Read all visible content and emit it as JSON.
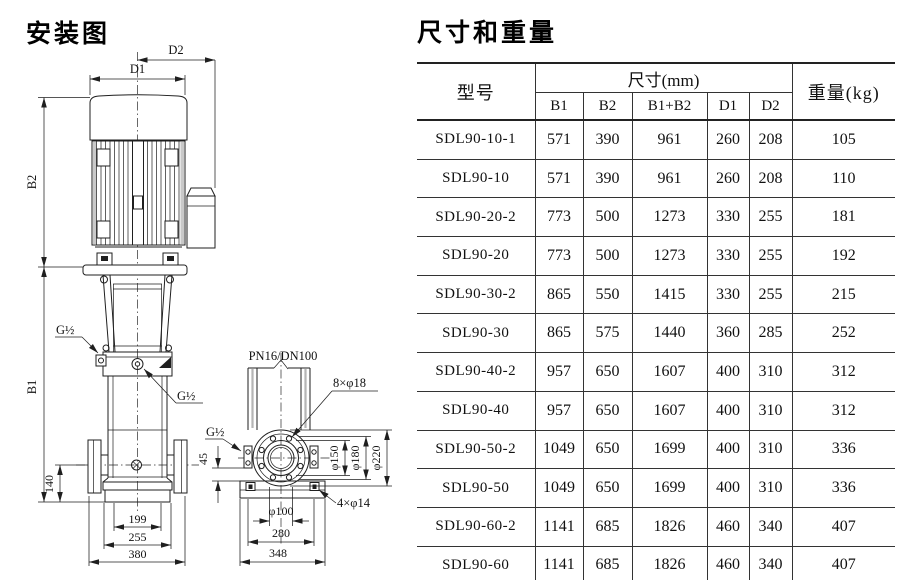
{
  "titles": {
    "installation": "安装图",
    "dimensions": "尺寸和重量"
  },
  "diagram": {
    "front": {
      "d1": "D1",
      "d2": "D2",
      "b1": "B1",
      "b2": "B2",
      "g_half_top": "G½",
      "g_half_mid": "G½",
      "dim_140": "140",
      "dim_199": "199",
      "dim_255": "255",
      "dim_380": "380"
    },
    "side": {
      "pn": "PN16/DN100",
      "g_half": "G½",
      "bolts_8": "8×φ18",
      "bolts_4": "4×φ14",
      "phi_150": "φ150",
      "phi_180": "φ180",
      "phi_220": "φ220",
      "phi_100": "φ100",
      "dim_45": "45",
      "dim_280": "280",
      "dim_348": "348"
    }
  },
  "table": {
    "col_model": "型号",
    "col_size": "尺寸(mm)",
    "col_weight": "重量(kg)",
    "size_cols": [
      "B1",
      "B2",
      "B1+B2",
      "D1",
      "D2"
    ],
    "rows": [
      {
        "model": "SDL90-10-1",
        "b1": "571",
        "b2": "390",
        "b1b2": "961",
        "d1": "260",
        "d2": "208",
        "weight": "105"
      },
      {
        "model": "SDL90-10",
        "b1": "571",
        "b2": "390",
        "b1b2": "961",
        "d1": "260",
        "d2": "208",
        "weight": "110"
      },
      {
        "model": "SDL90-20-2",
        "b1": "773",
        "b2": "500",
        "b1b2": "1273",
        "d1": "330",
        "d2": "255",
        "weight": "181"
      },
      {
        "model": "SDL90-20",
        "b1": "773",
        "b2": "500",
        "b1b2": "1273",
        "d1": "330",
        "d2": "255",
        "weight": "192"
      },
      {
        "model": "SDL90-30-2",
        "b1": "865",
        "b2": "550",
        "b1b2": "1415",
        "d1": "330",
        "d2": "255",
        "weight": "215"
      },
      {
        "model": "SDL90-30",
        "b1": "865",
        "b2": "575",
        "b1b2": "1440",
        "d1": "360",
        "d2": "285",
        "weight": "252"
      },
      {
        "model": "SDL90-40-2",
        "b1": "957",
        "b2": "650",
        "b1b2": "1607",
        "d1": "400",
        "d2": "310",
        "weight": "312"
      },
      {
        "model": "SDL90-40",
        "b1": "957",
        "b2": "650",
        "b1b2": "1607",
        "d1": "400",
        "d2": "310",
        "weight": "312"
      },
      {
        "model": "SDL90-50-2",
        "b1": "1049",
        "b2": "650",
        "b1b2": "1699",
        "d1": "400",
        "d2": "310",
        "weight": "336"
      },
      {
        "model": "SDL90-50",
        "b1": "1049",
        "b2": "650",
        "b1b2": "1699",
        "d1": "400",
        "d2": "310",
        "weight": "336"
      },
      {
        "model": "SDL90-60-2",
        "b1": "1141",
        "b2": "685",
        "b1b2": "1826",
        "d1": "460",
        "d2": "340",
        "weight": "407"
      },
      {
        "model": "SDL90-60",
        "b1": "1141",
        "b2": "685",
        "b1b2": "1826",
        "d1": "460",
        "d2": "340",
        "weight": "407"
      }
    ]
  }
}
